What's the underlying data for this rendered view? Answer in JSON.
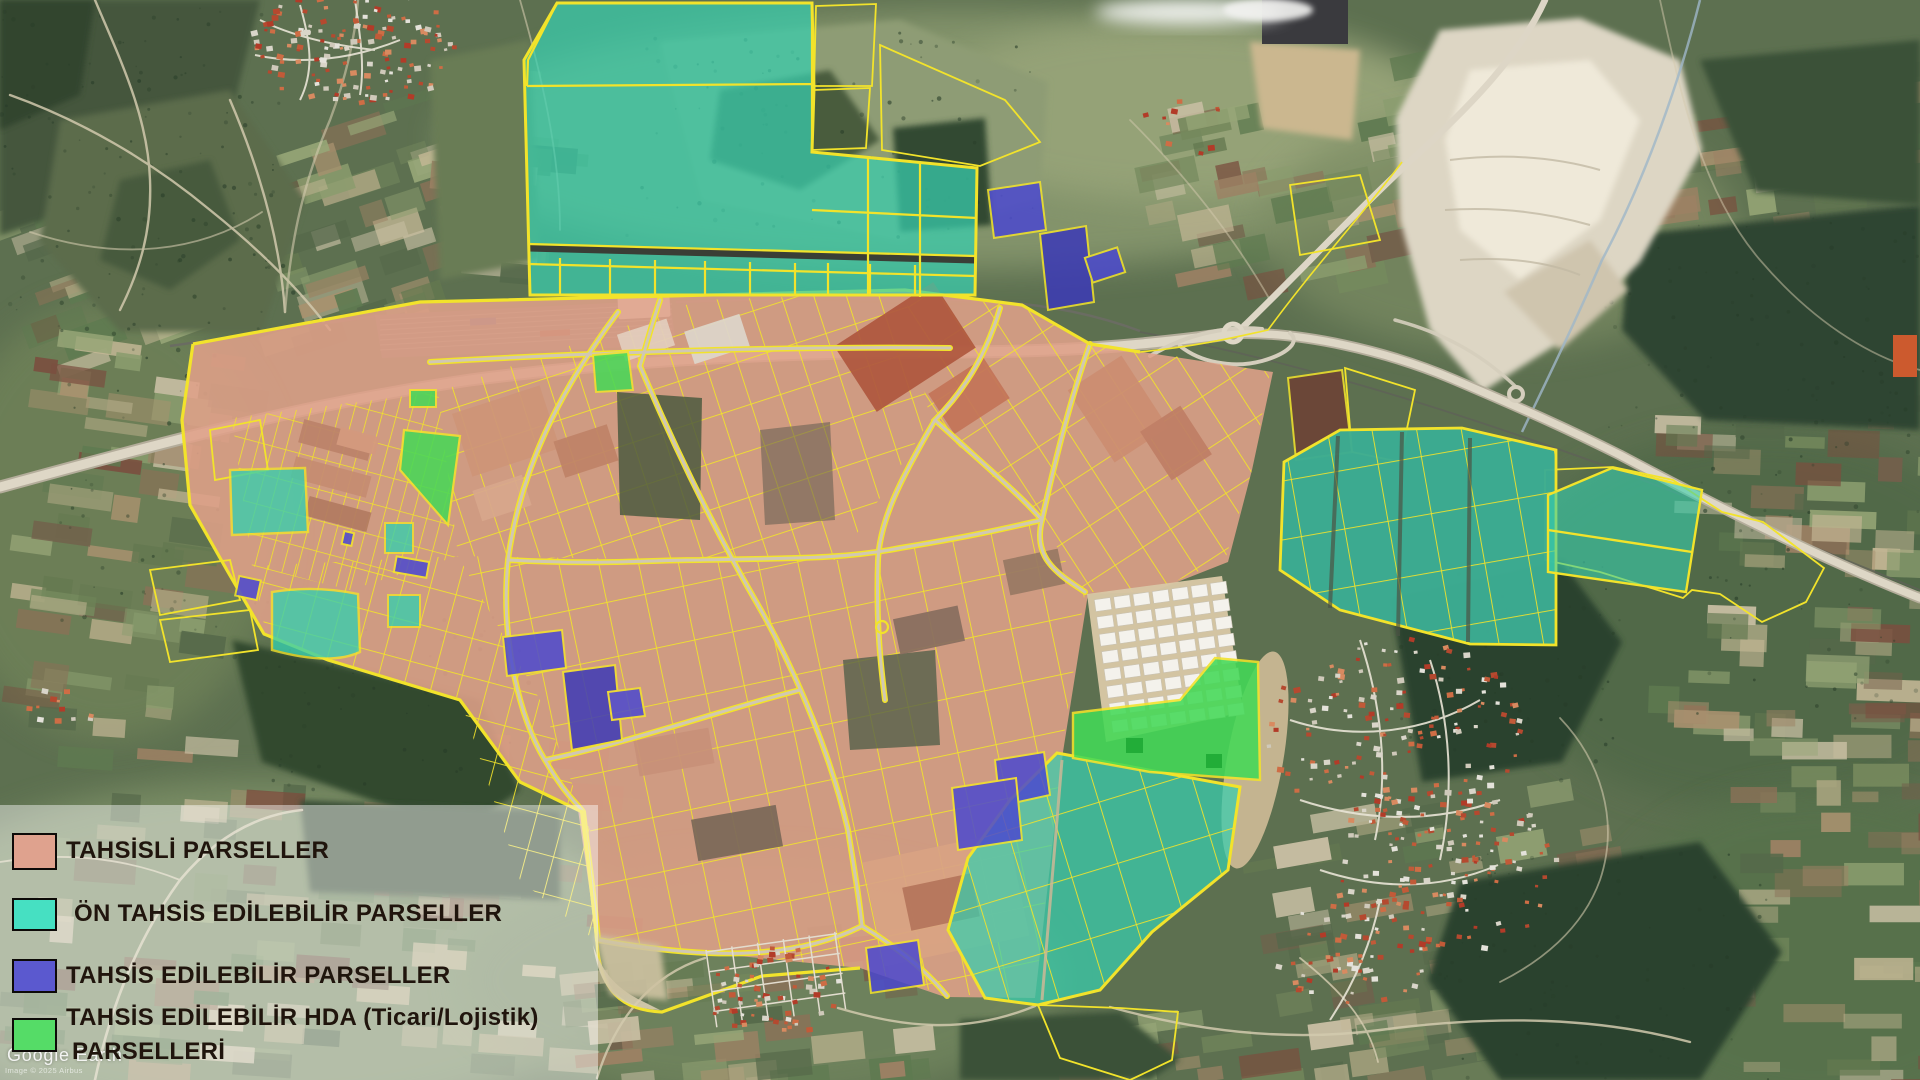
{
  "window": {
    "width": 1920,
    "height": 1080
  },
  "map": {
    "type": "satellite-imagery-with-parcel-overlay",
    "watermark": {
      "brand": "Google Earth",
      "credit": "Image © 2025 Airbus"
    },
    "legend": {
      "items": [
        {
          "id": "tahsisli",
          "label": "TAHSİSLİ PARSELLER",
          "color": "#dfa28e"
        },
        {
          "id": "on-tahsis",
          "label": "ÖN TAHSİS EDİLEBİLİR PARSELLER",
          "color": "#46e0c2"
        },
        {
          "id": "tahsis-edilebilir",
          "label": "TAHSİS EDİLEBİLİR PARSELLER",
          "color": "#5b59cf"
        },
        {
          "id": "hda",
          "label": "TAHSİS EDİLEBİLİR HDA (Ticari/Lojistik)",
          "label_line2": "PARSELLERİ",
          "color": "#55dc67"
        }
      ]
    },
    "overlay_colors": {
      "parcel_outline": "#f2e32b",
      "allocated_fill": "#dfa189",
      "pre_allocatable_fill": "#37cfae",
      "allocatable_fill": "#4b48cf",
      "hda_fill": "#44d957"
    }
  }
}
